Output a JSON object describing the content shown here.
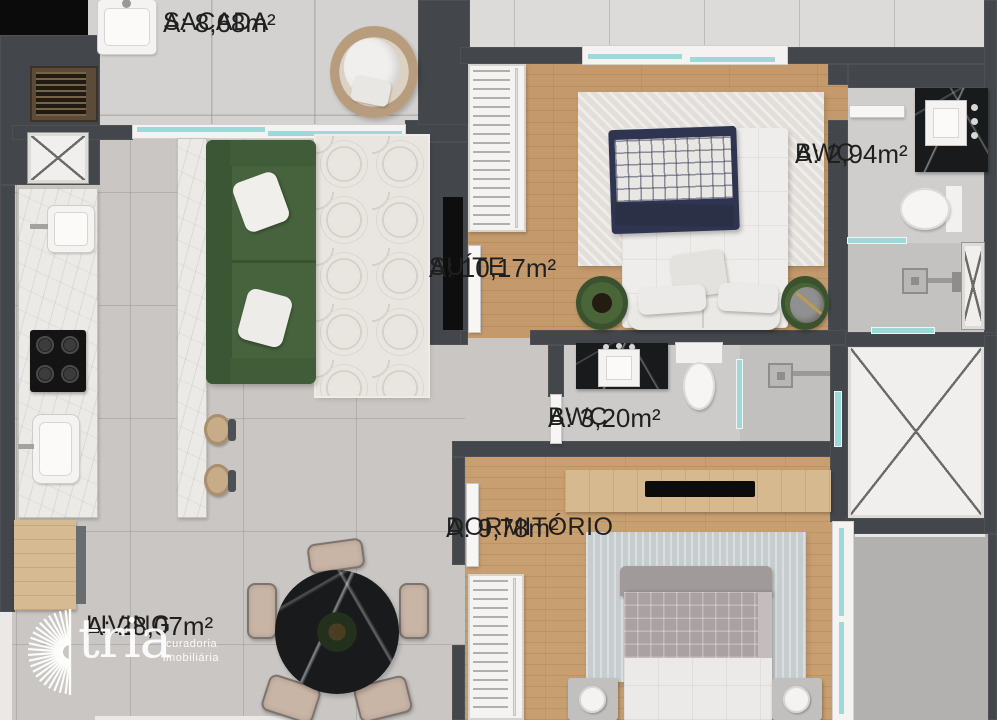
{
  "brand": {
    "name": "tria",
    "tagline1": "curadoria",
    "tagline2": "imobiliária",
    "logo_icon": "sunburst-icon",
    "color": "#ffffff"
  },
  "rooms": {
    "sacada": {
      "name": "SACADA",
      "area": "A: 8,68m²"
    },
    "suite": {
      "name": "SUÍTE",
      "area": "A: 10,17m²"
    },
    "bwc_suite": {
      "name": "BWC",
      "area": "A: 2,94m²"
    },
    "bwc_social": {
      "name": "BWC",
      "area": "A: 3,20m²"
    },
    "dormitorio": {
      "name": "DORMITÓRIO",
      "area": "A: 9,78m²"
    },
    "living": {
      "name": "LIVING",
      "area": "A: 28,07m²"
    }
  },
  "palette": {
    "wall": "#43464a",
    "wood_floor": "#c49a6c",
    "tile_floor": "#c9c6c3",
    "glass": "#9ed9da",
    "sofa_green": "#47633e",
    "rug_green": "#415c33",
    "black_marble": "#191a1c",
    "label_text": "#1f1f1f"
  }
}
